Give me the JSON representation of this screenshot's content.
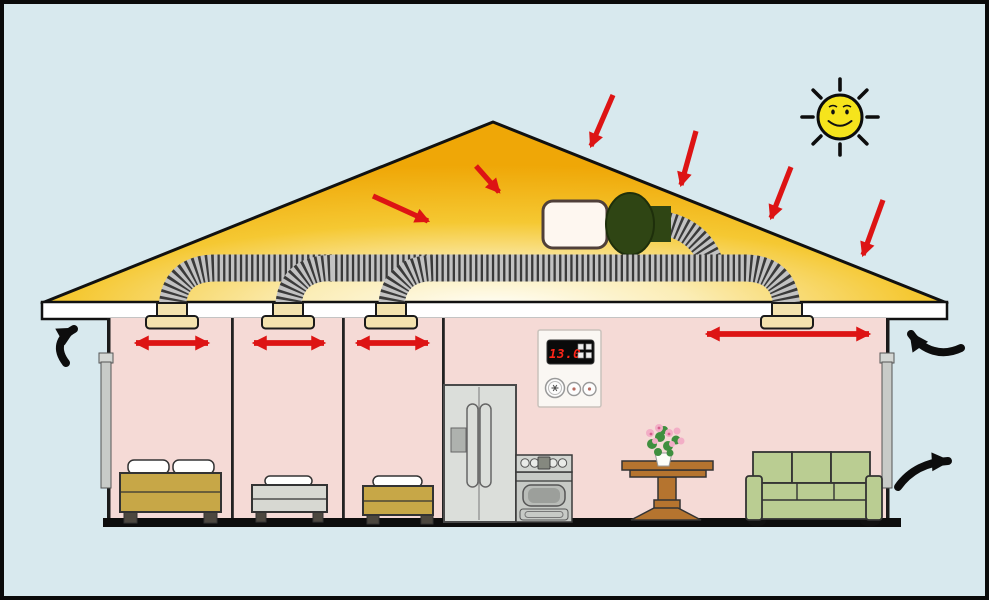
{
  "diagram": {
    "subject": "house-attic-fan-cooling-diagram"
  },
  "thermostat": {
    "display_value": "13.0"
  },
  "colors": {
    "sky": "#D8E9EE",
    "roof_gold": "#EFA80A",
    "roof_glow": "#FFFDF2",
    "wall_pink": "#F5DAD6",
    "ceiling_white": "#FFFFFF",
    "arrow_red": "#DD1414",
    "arrow_black": "#0D0D0D",
    "sun_yellow": "#F6E41C",
    "duct_dark": "#3A3A3A",
    "duct_light": "#C2C2C2",
    "vent_beige": "#F3E2AE",
    "fan_green": "#2F4514",
    "fan_box_white": "#FEF7F0",
    "sofa_green": "#BACD92",
    "bed_tan": "#C7A747",
    "bed_gray": "#D7D8D2",
    "table_brown": "#B5742F",
    "appliance_gray": "#D3D6D3",
    "floor_black": "#0D0D0D"
  },
  "sun": {
    "cx": 840,
    "cy": 117,
    "radius": 22,
    "ray_count": 8
  },
  "sun_ray_arrows": [
    {
      "x1": 613,
      "y1": 95,
      "x2": 591,
      "y2": 146
    },
    {
      "x1": 696,
      "y1": 131,
      "x2": 681,
      "y2": 185
    },
    {
      "x1": 791,
      "y1": 167,
      "x2": 771,
      "y2": 218
    },
    {
      "x1": 883,
      "y1": 200,
      "x2": 863,
      "y2": 255
    }
  ],
  "attic_heat_arrows": [
    {
      "x1": 373,
      "y1": 196,
      "x2": 428,
      "y2": 221
    },
    {
      "x1": 476,
      "y1": 166,
      "x2": 499,
      "y2": 192
    }
  ],
  "ceiling_vents": [
    {
      "cx": 172
    },
    {
      "cx": 288
    },
    {
      "cx": 391
    },
    {
      "cx": 787
    }
  ],
  "room_airflow_arrows": [
    {
      "x1": 132,
      "x2": 212,
      "y": 343
    },
    {
      "x1": 250,
      "x2": 328,
      "y": 343
    },
    {
      "x1": 353,
      "x2": 432,
      "y": 343
    },
    {
      "x1": 703,
      "x2": 873,
      "y": 334
    }
  ],
  "eave_airflow_arrows": [
    {
      "d": "M 66 363 C 56 350 58 338 74 329"
    },
    {
      "d": "M 961 348 C 942 357 923 351 911 334"
    },
    {
      "d": "M 898 487 C 910 470 928 462 948 461 "
    }
  ]
}
